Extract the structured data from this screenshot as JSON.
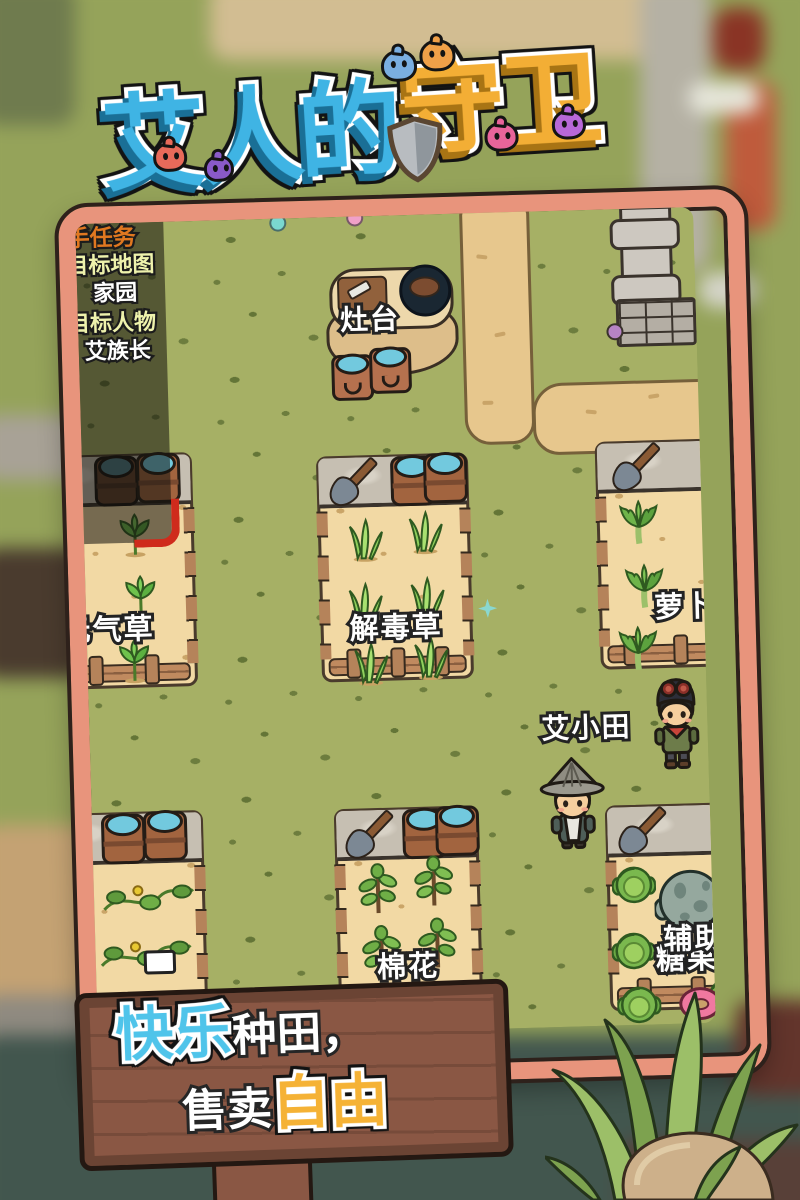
{
  "title": {
    "part1": "艾人的",
    "part2": "守卫"
  },
  "quest_panel": {
    "header": "新手任务",
    "goal_map_label": "目标地图",
    "goal_map_value": "家园",
    "goal_person_label": "目标人物",
    "goal_person_value": "艾族长"
  },
  "map": {
    "stove_label": "灶台",
    "plot_labels": {
      "upper_left": "元气草",
      "upper_middle": "解毒草",
      "upper_right": "萝卜",
      "lower_middle": "棉花",
      "lower_right_primary": "辅助",
      "lower_right_secondary": "糖果"
    },
    "npc_name": "艾小田"
  },
  "sign": {
    "line1_highlight": "快乐",
    "line1_rest": "种田",
    "line1_comma": "，",
    "line2_rest": "售卖",
    "line2_highlight": "自由"
  },
  "colors": {
    "frame": "#e8947c",
    "grass": "#a6b065",
    "path_sand": "#e7c78d",
    "plot_sand": "#f2d9a4",
    "sign_board": "#8a5744",
    "title_blue": "#3fb4e4",
    "title_gold": "#f3ae35",
    "highlight_red": "#cf2b1c"
  },
  "icons": {
    "shield": "shield-icon",
    "shovel": "shovel-icon",
    "barrel": "barrel-icon",
    "bucket": "bucket-icon",
    "sparkle": "sparkle-icon",
    "donut": "donut-icon"
  }
}
